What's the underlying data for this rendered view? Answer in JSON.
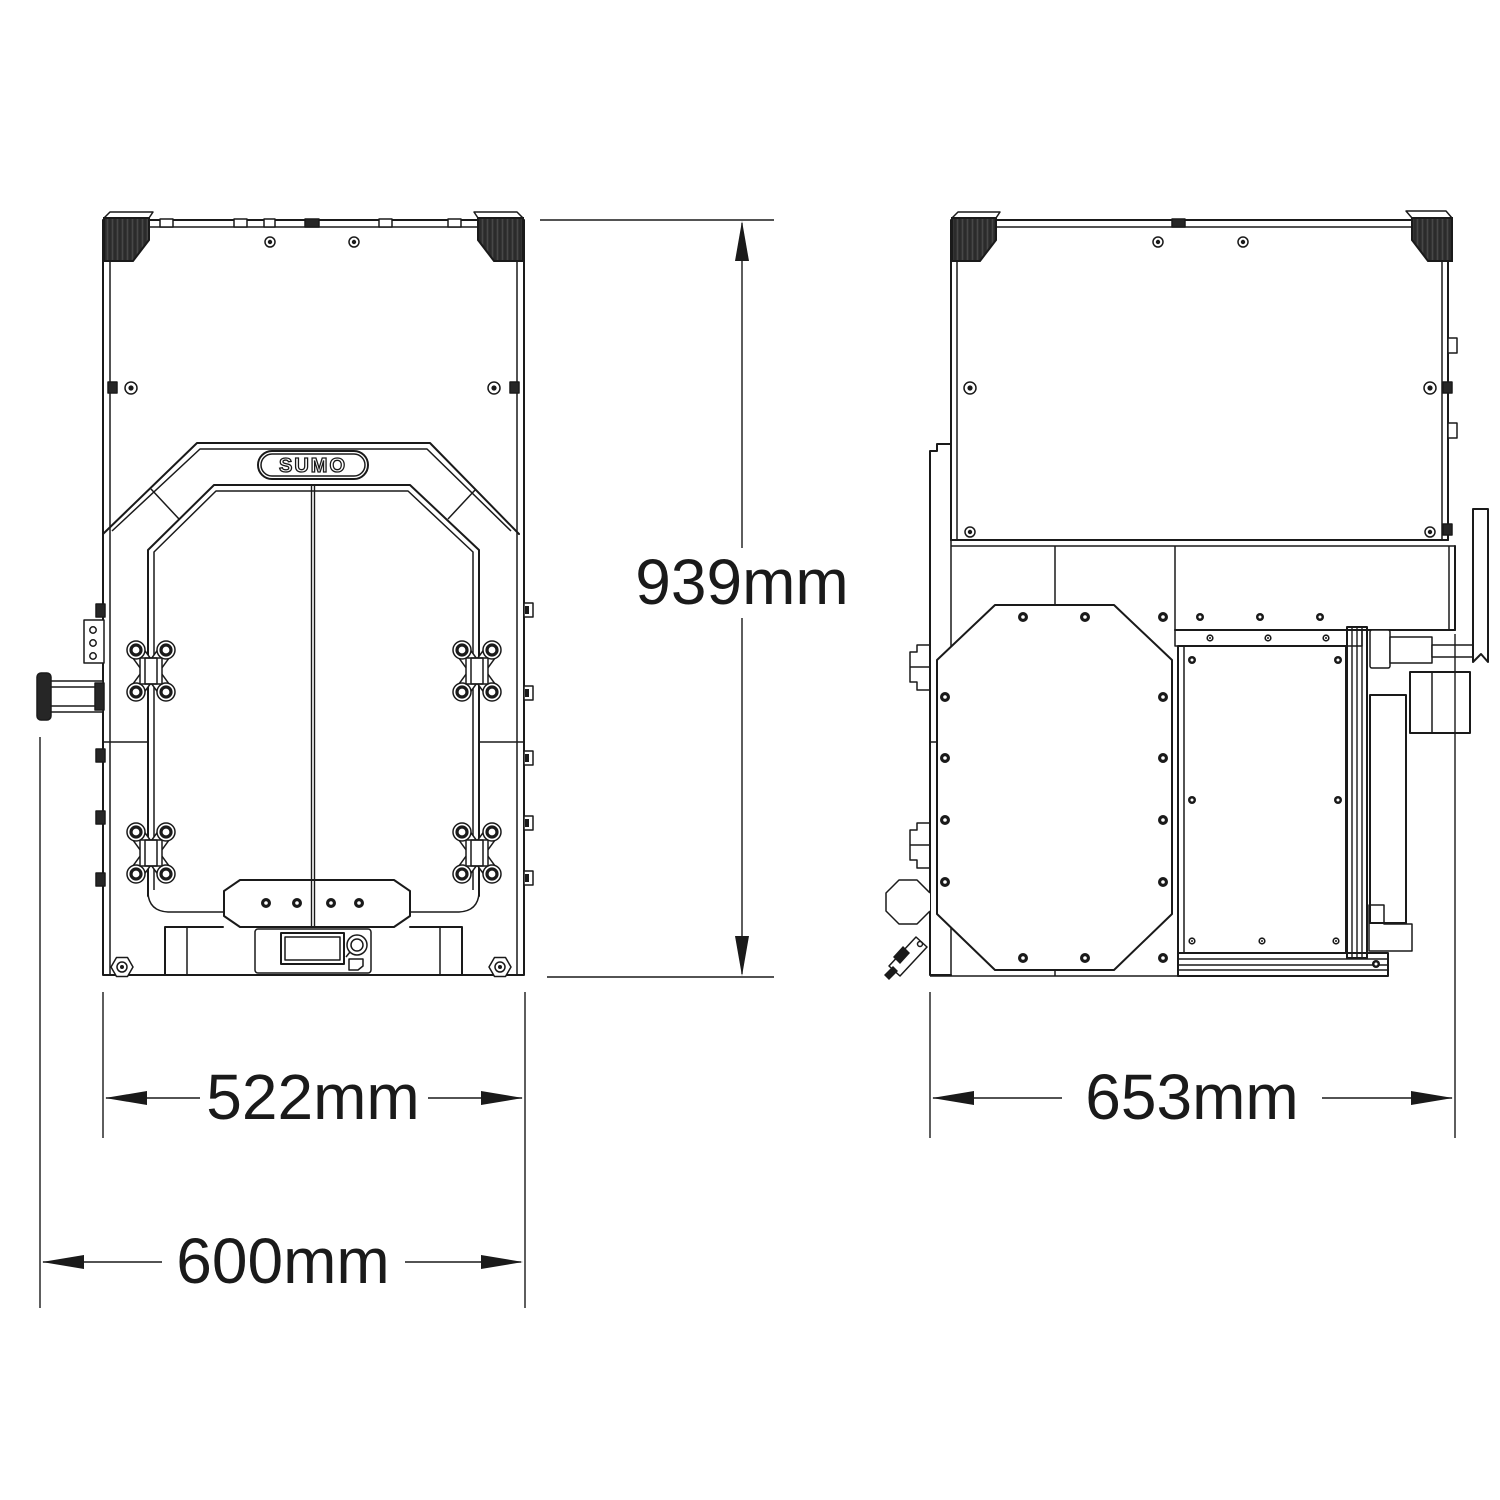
{
  "brand": {
    "label": "SUMO"
  },
  "dimensions": {
    "height": "939mm",
    "frame_width": "522mm",
    "overall_width": "600mm",
    "depth": "653mm"
  },
  "colors": {
    "line": "#1a1a1a",
    "dark_fill": "#262626",
    "background": "#ffffff"
  }
}
